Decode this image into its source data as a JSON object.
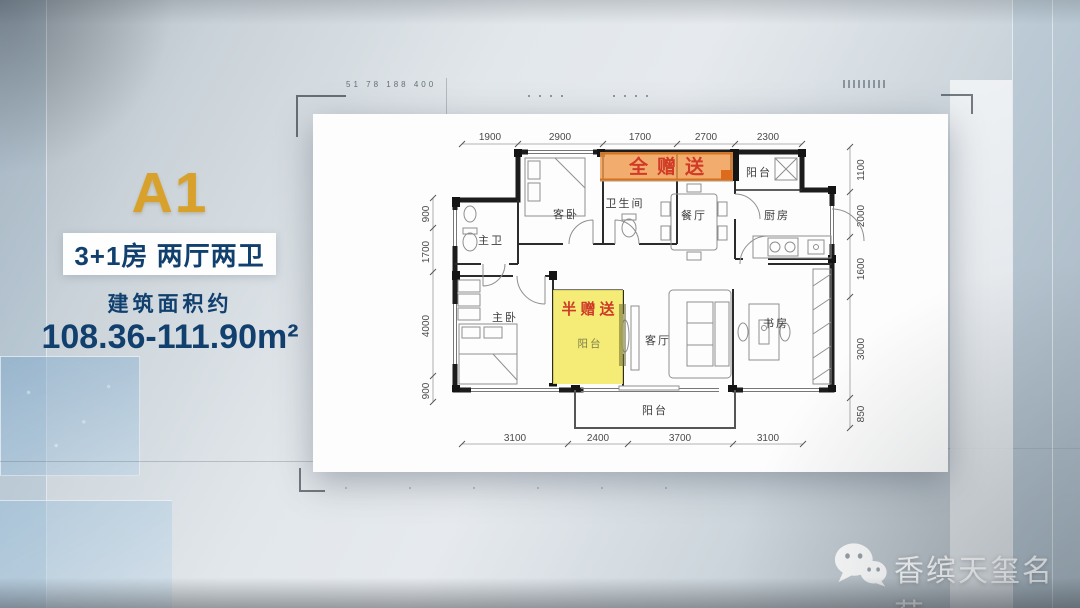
{
  "left_panel": {
    "unit": "A1",
    "layout": "3+1房  两厅两卫",
    "area_label": "建筑面积约",
    "area_value": "108.36-111.90m²"
  },
  "plan": {
    "gift_full": "全赠送",
    "gift_half": "半赠送",
    "rooms": {
      "master_bath": "主卫",
      "guest_bed": "客卧",
      "bathroom": "卫生间",
      "dining": "餐厅",
      "balcony_top": "阳台",
      "kitchen": "厨房",
      "master_bed": "主卧",
      "balcony_half": "阳台",
      "living": "客厅",
      "study": "书房",
      "balcony_bottom": "阳台"
    },
    "dims_top": [
      "1900",
      "2900",
      "1700",
      "2700",
      "2300"
    ],
    "dims_bottom": [
      "3100",
      "2400",
      "3700",
      "3100"
    ],
    "dims_left": [
      "900",
      "1700",
      "4000",
      "900"
    ],
    "dims_right": [
      "1100",
      "2000",
      "1600",
      "3000",
      "850"
    ]
  },
  "brand": {
    "name": "香缤天玺名苑",
    "icon": "wechat-icon"
  },
  "decor": {
    "ruler_text": "51 78 188 400"
  },
  "colors": {
    "gold": "#d7a12c",
    "navy": "#12406e",
    "highlight_orange": "#ef9a4d",
    "highlight_yellow": "#f2e95e",
    "gift_text_red": "#d03a28",
    "card_white": "#fdfdfd"
  }
}
